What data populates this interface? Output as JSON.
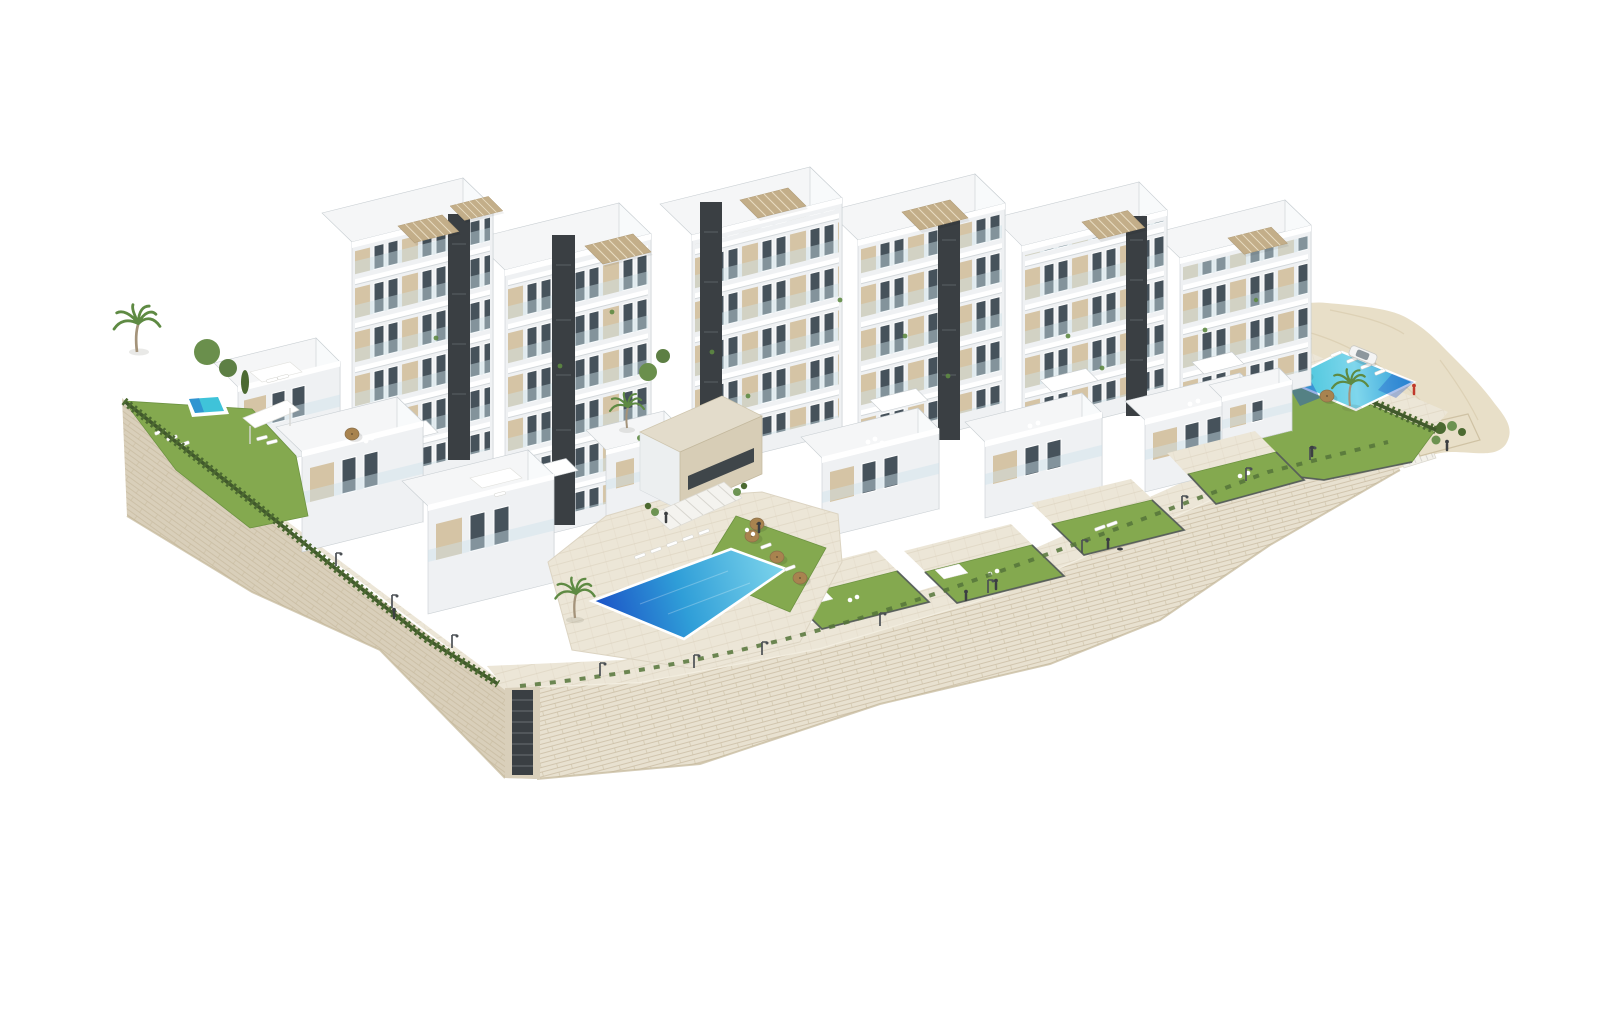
{
  "scene": {
    "subject": "Aerial 3D architectural rendering of a modern white hillside apartment complex",
    "style": "photorealistic CGI, isometric aerial view, pure white background",
    "inventory": {
      "apartment_towers": 7,
      "terraced_podium_villas": 8,
      "swimming_pools": 3,
      "rooftop_pergolas": 8,
      "palm_trees": 5,
      "parasols": 6,
      "sun_loungers": 16,
      "street_lamps": 12,
      "people": 8,
      "parked_cars": 1,
      "staircases": 3,
      "private_gardens": 6
    }
  },
  "palette": {
    "background": "#ffffff",
    "white_face": "#eff1f3",
    "bright_face": "#f8fafb",
    "top_face": "#f5f6f7",
    "edge": "#c9cfd3",
    "charcoal": "#3a3f43",
    "glass": "#46525b",
    "glass_rail": "#cfe2ea",
    "beige": "#d5c4a5",
    "pergola": "#c3ae89",
    "pergola_slat": "#e8dcc2",
    "stone_wall": "#e8e1d0",
    "stone_line": "#c6b99d",
    "stone_dark": "#d9cfba",
    "paving": "#ece6d7",
    "paving_line": "#d9d0bc",
    "sand": "#e8dfc8",
    "sand_line": "#d3c5a6",
    "lawn": "#84a94f",
    "lawn_dark": "#6d9342",
    "hedge": "#4c6a31",
    "palm": "#5e8a43",
    "trunk": "#a4937a",
    "pool_deep": "#1b50c6",
    "pool_mid": "#2f9ed8",
    "pool_light": "#7fd6ec",
    "pool_teal": "#3fc3d9",
    "umbrella": "#a8834f",
    "lamp": "#4b5054",
    "person": "#3c3f42",
    "accent_red": "#c0392b",
    "car_body": "#f4f4f4",
    "car_glass": "#8d979e"
  }
}
